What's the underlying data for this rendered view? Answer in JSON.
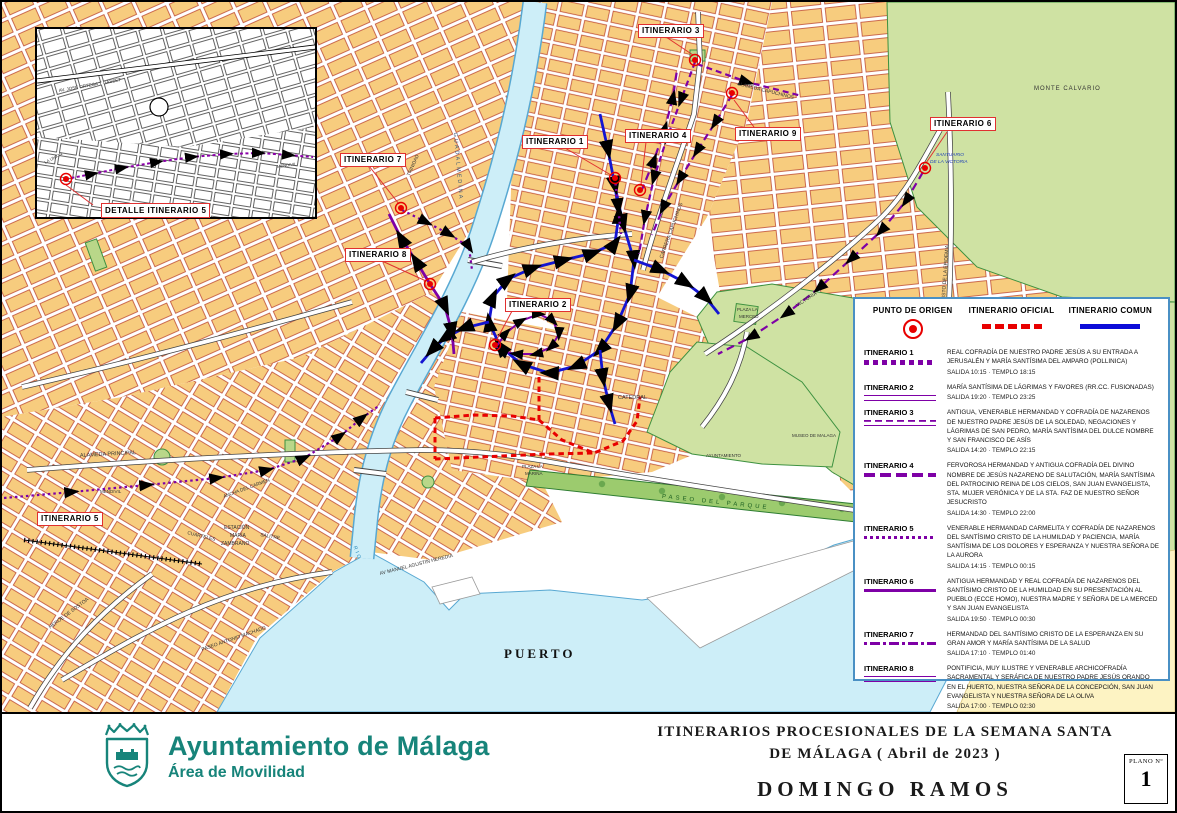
{
  "inset": {
    "label": "DETALLE ITINERARIO 5",
    "street_labels": [
      {
        "t": "AV. JOSE ORTEGA Y GASSET",
        "x": 22,
        "y": 60,
        "s": 4.5,
        "r": -10
      },
      {
        "t": "LA UNION",
        "x": 8,
        "y": 132,
        "s": 4.2,
        "r": -28
      },
      {
        "t": "MENDIVIL",
        "x": 240,
        "y": 136,
        "s": 4.2,
        "r": -8
      }
    ]
  },
  "map": {
    "itinerary_markers": [
      {
        "label": "ITINERARIO 1",
        "x": 520,
        "y": 133
      },
      {
        "label": "ITINERARIO 2",
        "x": 503,
        "y": 296
      },
      {
        "label": "ITINERARIO 3",
        "x": 636,
        "y": 22
      },
      {
        "label": "ITINERARIO 4",
        "x": 623,
        "y": 127
      },
      {
        "label": "ITINERARIO 5",
        "x": 35,
        "y": 510
      },
      {
        "label": "ITINERARIO 6",
        "x": 928,
        "y": 115
      },
      {
        "label": "ITINERARIO 7",
        "x": 338,
        "y": 151
      },
      {
        "label": "ITINERARIO 8",
        "x": 343,
        "y": 246
      },
      {
        "label": "ITINERARIO 9",
        "x": 733,
        "y": 125
      }
    ],
    "street_labels": [
      {
        "t": "PUERTO",
        "x": 502,
        "y": 645,
        "s": 13,
        "b": 1,
        "f": 1,
        "ls": 3,
        "c": "#111"
      },
      {
        "t": "MONTE CALVARIO",
        "x": 1032,
        "y": 84,
        "s": 6,
        "ls": 1
      },
      {
        "t": "GUADALMEDINA",
        "x": 452,
        "y": 128,
        "s": 5.5,
        "r": 85,
        "ls": 2,
        "c": "#335577"
      },
      {
        "t": "ALAMEDA PRINCIPAL",
        "x": 78,
        "y": 452,
        "s": 5.5,
        "r": -3
      },
      {
        "t": "PASEO DEL PARQUE",
        "x": 660,
        "y": 492,
        "s": 6,
        "r": 6,
        "ls": 3,
        "c": "#1b5e20"
      },
      {
        "t": "CATEDRAL",
        "x": 616,
        "y": 394,
        "s": 5.5
      },
      {
        "t": "AYUNTAMIENTO",
        "x": 704,
        "y": 452,
        "s": 4.5
      },
      {
        "t": "MUSEO DE MALAGA",
        "x": 790,
        "y": 432,
        "s": 4.5
      },
      {
        "t": "ESTACIÓN",
        "x": 222,
        "y": 524,
        "s": 5
      },
      {
        "t": "MARÍA",
        "x": 228,
        "y": 532,
        "s": 5
      },
      {
        "t": "ZAMBRANO",
        "x": 219,
        "y": 540,
        "s": 5
      },
      {
        "t": "SANTUARIO",
        "x": 934,
        "y": 152,
        "s": 4.8,
        "i": 1,
        "c": "#2143b8"
      },
      {
        "t": "DE LA VICTORIA",
        "x": 928,
        "y": 159,
        "s": 4.8,
        "i": 1,
        "c": "#2143b8"
      },
      {
        "t": "PLAZA LA",
        "x": 735,
        "y": 306,
        "s": 4.5
      },
      {
        "t": "MERCED",
        "x": 737,
        "y": 313,
        "s": 4.5
      },
      {
        "t": "PLAZA LA",
        "x": 520,
        "y": 463,
        "s": 4.5
      },
      {
        "t": "MARINA",
        "x": 523,
        "y": 470,
        "s": 4.5
      },
      {
        "t": "AV MANUEL AGUSTIN HEREDIA",
        "x": 378,
        "y": 570,
        "s": 5,
        "r": -14
      },
      {
        "t": "PASEO ANTONIO MACHADO",
        "x": 200,
        "y": 646,
        "s": 5,
        "r": -19
      },
      {
        "t": "HEROE DE SOSTOA",
        "x": 48,
        "y": 624,
        "s": 5,
        "r": -37
      },
      {
        "t": "MENDIVIL",
        "x": 98,
        "y": 488,
        "s": 4.5
      },
      {
        "t": "CUARTELES",
        "x": 185,
        "y": 530,
        "s": 4.8,
        "r": 14
      },
      {
        "t": "SALITRE",
        "x": 258,
        "y": 532,
        "s": 4.8,
        "r": 10
      },
      {
        "t": "ANCHA DEL CARMEN",
        "x": 222,
        "y": 494,
        "s": 4.8,
        "r": -20
      },
      {
        "t": "TRINIDAD",
        "x": 408,
        "y": 172,
        "s": 4.8,
        "r": -66
      },
      {
        "t": "CARRERA CAPUCHINOS",
        "x": 660,
        "y": 254,
        "s": 5,
        "r": -70
      },
      {
        "t": "ALAMEDA CAPUCHINOS",
        "x": 735,
        "y": 80,
        "s": 5,
        "r": 14
      },
      {
        "t": "VICTORIA",
        "x": 795,
        "y": 302,
        "s": 5,
        "r": -33
      },
      {
        "t": "CRISTO DE LA EPIDEMIA",
        "x": 942,
        "y": 300,
        "s": 5,
        "r": -86
      },
      {
        "t": "RIO",
        "x": 352,
        "y": 542,
        "s": 5,
        "r": 70,
        "ls": 2,
        "c": "#2288bb"
      }
    ]
  },
  "legend": {
    "header": {
      "origin": "PUNTO DE ORIGEN",
      "oficial": "ITINERARIO OFICIAL",
      "comun": "ITINERARIO COMUN"
    },
    "colors": {
      "oficial": "#e80000",
      "comun": "#0c0cd8",
      "itinerario": "#7e00a6",
      "origin": "#e80000"
    },
    "entries": [
      {
        "name": "ITINERARIO 1",
        "style": "dotted",
        "desc": "REAL COFRADÍA DE NUESTRO PADRE JESÚS A SU ENTRADA A JERUSALÉN Y MARÍA SANTÍSIMA DEL AMPARO (POLLINICA)",
        "salida": "SALIDA 10:15 · TEMPLO 18:15"
      },
      {
        "name": "ITINERARIO 2",
        "style": "double",
        "desc": "MARÍA SANTÍSIMA DE LÁGRIMAS Y FAVORES (RR.CC. FUSIONADAS)",
        "salida": "SALIDA 19:20 · TEMPLO 23:25"
      },
      {
        "name": "ITINERARIO 3",
        "style": "dashsolid",
        "desc": "ANTIGUA, VENERABLE HERMANDAD Y COFRADÍA DE NAZARENOS DE NUESTRO PADRE JESÚS DE LA SOLEDAD, NEGACIONES Y LÁGRIMAS DE SAN PEDRO, MARÍA SANTÍSIMA DEL DULCE NOMBRE Y SAN FRANCISCO DE ASÍS",
        "salida": "SALIDA 14:20 · TEMPLO 22:15"
      },
      {
        "name": "ITINERARIO 4",
        "style": "longdash",
        "desc": "FERVOROSA HERMANDAD Y ANTIGUA COFRADÍA DEL DIVINO NOMBRE DE JESÚS NAZARENO DE SALUTACIÓN, MARÍA SANTÍSIMA DEL PATROCINIO REINA DE LOS CIELOS, SAN JUAN EVANGELISTA, STA. MUJER VERÓNICA Y DE LA STA. FAZ DE NUESTRO SEÑOR JESUCRISTO",
        "salida": "SALIDA 14:30 · TEMPLO 22:00"
      },
      {
        "name": "ITINERARIO 5",
        "style": "finedot",
        "desc": "VENERABLE HERMANDAD CARMELITA Y COFRADÍA DE NAZARENOS DEL SANTÍSIMO CRISTO DE LA HUMILDAD Y PACIENCIA, MARÍA SANTÍSIMA DE LOS DOLORES Y ESPERANZA Y NUESTRA SEÑORA DE LA AURORA",
        "salida": "SALIDA 14:15 · TEMPLO 00:15"
      },
      {
        "name": "ITINERARIO 6",
        "style": "solid",
        "desc": "ANTIGUA HERMANDAD Y REAL COFRADÍA DE NAZARENOS DEL SANTÍSIMO CRISTO DE LA HUMILDAD EN SU PRESENTACIÓN AL PUEBLO (ECCE HOMO), NUESTRA MADRE Y SEÑORA DE LA MERCED Y SAN JUAN EVANGELISTA",
        "salida": "SALIDA 19:50 · TEMPLO 00:30"
      },
      {
        "name": "ITINERARIO 7",
        "style": "dashdot",
        "desc": "HERMANDAD DEL SANTÍSIMO CRISTO DE LA ESPERANZA EN SU GRAN AMOR Y MARÍA SANTÍSIMA DE LA SALUD",
        "salida": "SALIDA 17:10 · TEMPLO 01:40"
      },
      {
        "name": "ITINERARIO 8",
        "style": "double",
        "desc": "PONTIFICIA, MUY ILUSTRE Y VENERABLE ARCHICOFRADÍA SACRAMENTAL Y SERÁFICA DE NUESTRO PADRE JESÚS ORANDO EN EL HUERTO, NUESTRA SEÑORA DE LA CONCEPCIÓN, SAN JUAN EVANGELISTA Y NUESTRA SEÑORA DE LA OLIVA",
        "salida": "SALIDA 17:00 · TEMPLO 02:30"
      },
      {
        "name": "ITINERARIO 9",
        "style": "longdash",
        "desc": "FERVOROSA Y MUY ILUSTRE HERMANDAD DE NUESTRO PADRE JESÚS DEL PRENDIMIENTO Y MARÍA SANTÍSIMA DEL GRAN PERDÓN",
        "salida": "SALIDA 19:30 · TEMPLO 01:20"
      }
    ]
  },
  "footer": {
    "org": "Ayuntamiento de Málaga",
    "dept": "Área de Movilidad",
    "brand_color": "#17847a",
    "title_line1": "ITINERARIOS PROCESIONALES DE LA SEMANA SANTA",
    "title_line2": "DE MÁLAGA ( Abril de 2023 )",
    "title_line3": "DOMINGO RAMOS",
    "plano_label": "PLANO Nº",
    "plano_number": "1"
  }
}
